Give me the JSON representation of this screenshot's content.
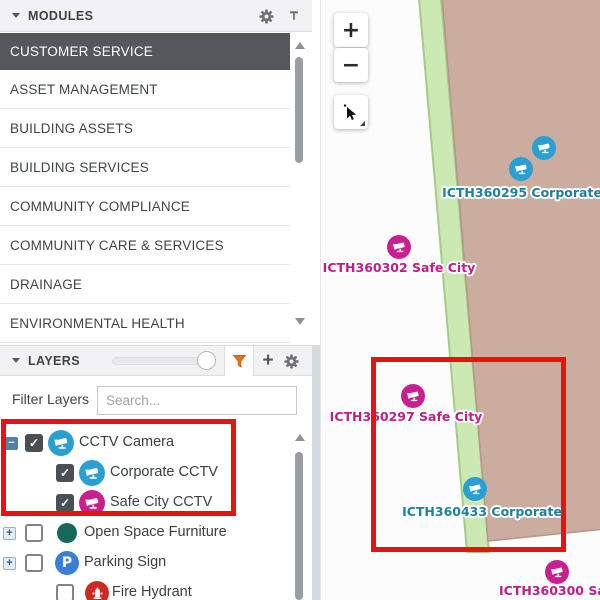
{
  "modules_panel": {
    "title": "MODULES",
    "selected_item": "CUSTOMER SERVICE",
    "items": [
      "CUSTOMER SERVICE",
      "ASSET MANAGEMENT",
      "BUILDING ASSETS",
      "BUILDING SERVICES",
      "COMMUNITY COMPLIANCE",
      "COMMUNITY CARE & SERVICES",
      "DRAINAGE",
      "ENVIRONMENTAL HEALTH"
    ]
  },
  "layers_panel": {
    "title": "LAYERS",
    "filter_label": "Filter Layers",
    "search_placeholder": "Search...",
    "tree": [
      {
        "label": "CCTV Camera",
        "checked": true,
        "check": "✓",
        "toggle": "−",
        "icon": "cctv-camera",
        "color": "#2a9fd3"
      },
      {
        "label": "Corporate CCTV",
        "checked": true,
        "check": "✓",
        "toggle": "",
        "icon": "cctv-camera",
        "color": "#2a9fd3"
      },
      {
        "label": "Safe City CCTV",
        "checked": true,
        "check": "✓",
        "toggle": "",
        "icon": "cctv-camera",
        "color": "#c9208f"
      },
      {
        "label": "Open Space Furniture",
        "checked": false,
        "check": "",
        "toggle": "+",
        "icon": "circle",
        "color": "#16695a"
      },
      {
        "label": "Parking Sign",
        "checked": false,
        "check": "",
        "toggle": "+",
        "icon": "parking",
        "icon_letter": "P",
        "color": "#3b7ed7"
      },
      {
        "label": "Fire Hydrant",
        "checked": false,
        "check": "",
        "toggle": "",
        "icon": "fire-hydrant",
        "color": "#cd2a21"
      }
    ]
  },
  "map": {
    "controls": {
      "zoom_in": "+",
      "zoom_out": "−",
      "pointer": "select-cursor"
    },
    "marker_colors": {
      "corporate": "#2a9fd3",
      "safe_city": "#c9208f"
    },
    "label_colors": {
      "corporate": "#1e7f9e",
      "safe_city": "#bb1e8d"
    },
    "terrain": {
      "parcel_fill": "#cbada0",
      "parcel_stroke": "#b89584",
      "road_fill": "#cce9b4",
      "road_stroke": "#a3cc89"
    },
    "markers": [
      {
        "type": "corporate"
      },
      {
        "type": "corporate"
      },
      {
        "type": "safe_city"
      },
      {
        "type": "safe_city"
      },
      {
        "type": "corporate"
      },
      {
        "type": "safe_city"
      }
    ],
    "labels": [
      {
        "text": "ICTH360295 Corporate",
        "type": "corporate"
      },
      {
        "text": "ICTH360302 Safe City",
        "type": "safe_city"
      },
      {
        "text": "ICTH360297 Safe City",
        "type": "safe_city"
      },
      {
        "text": "ICTH360433 Corporate",
        "type": "corporate"
      },
      {
        "text": "ICTH360300 Safe",
        "type": "safe_city"
      }
    ]
  },
  "annotations": {
    "highlight_color": "#ea120d"
  }
}
